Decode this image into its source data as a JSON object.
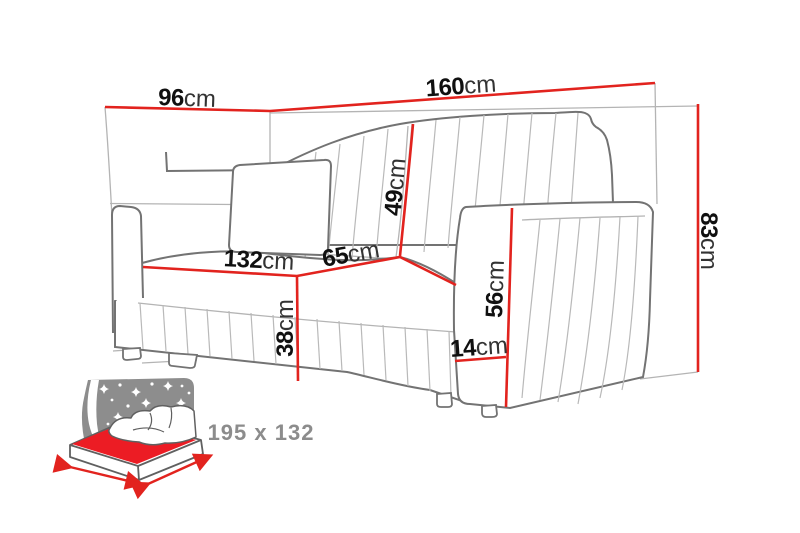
{
  "title": "Sofa dimensions diagram",
  "colors": {
    "dimension_line_red": "#e2231e",
    "sofa_outline_gray": "#737373",
    "construction_line_gray": "#b4b4b4",
    "label_number_color": "#101010",
    "label_unit_color": "#333333",
    "sleep_icon_gray": "#8d8d8d",
    "mattress_red": "#ec1c24",
    "background": "#ffffff"
  },
  "dimensions": [
    {
      "name": "total-depth",
      "value": "96",
      "unit": "cm"
    },
    {
      "name": "total-width",
      "value": "160",
      "unit": "cm"
    },
    {
      "name": "total-height",
      "value": "83",
      "unit": "cm"
    },
    {
      "name": "backrest-height",
      "value": "49",
      "unit": "cm"
    },
    {
      "name": "seat-depth",
      "value": "65",
      "unit": "cm"
    },
    {
      "name": "seat-width",
      "value": "132",
      "unit": "cm"
    },
    {
      "name": "seat-height",
      "value": "38",
      "unit": "cm"
    },
    {
      "name": "armrest-height",
      "value": "56",
      "unit": "cm"
    },
    {
      "name": "armrest-width",
      "value": "14",
      "unit": "cm"
    }
  ],
  "sleeping_function": {
    "dimensions_label": "195 x 132"
  }
}
